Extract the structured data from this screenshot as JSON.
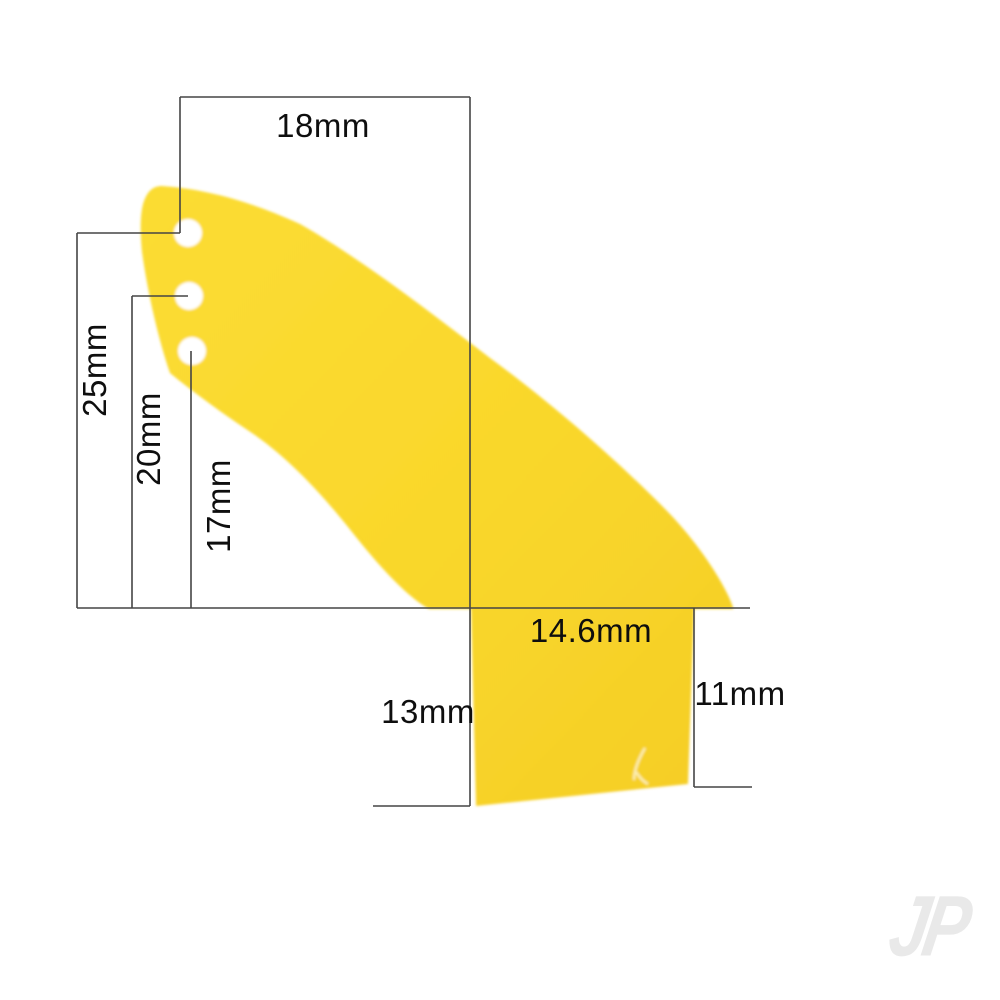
{
  "diagram": {
    "subject": "yellow control horn with three mounting holes, dimensioned drawing",
    "part_color": "#f9d72b",
    "line_color": "#454545",
    "background_color": "#ffffff"
  },
  "dimensions": {
    "top_width": "18mm",
    "hole1_height": "25mm",
    "hole2_height": "20mm",
    "hole3_height": "17mm",
    "base_width": "14.6mm",
    "base_left_height": "13mm",
    "base_right_height": "11mm"
  },
  "watermark": {
    "text": "JP",
    "color": "#e9e9e9"
  }
}
